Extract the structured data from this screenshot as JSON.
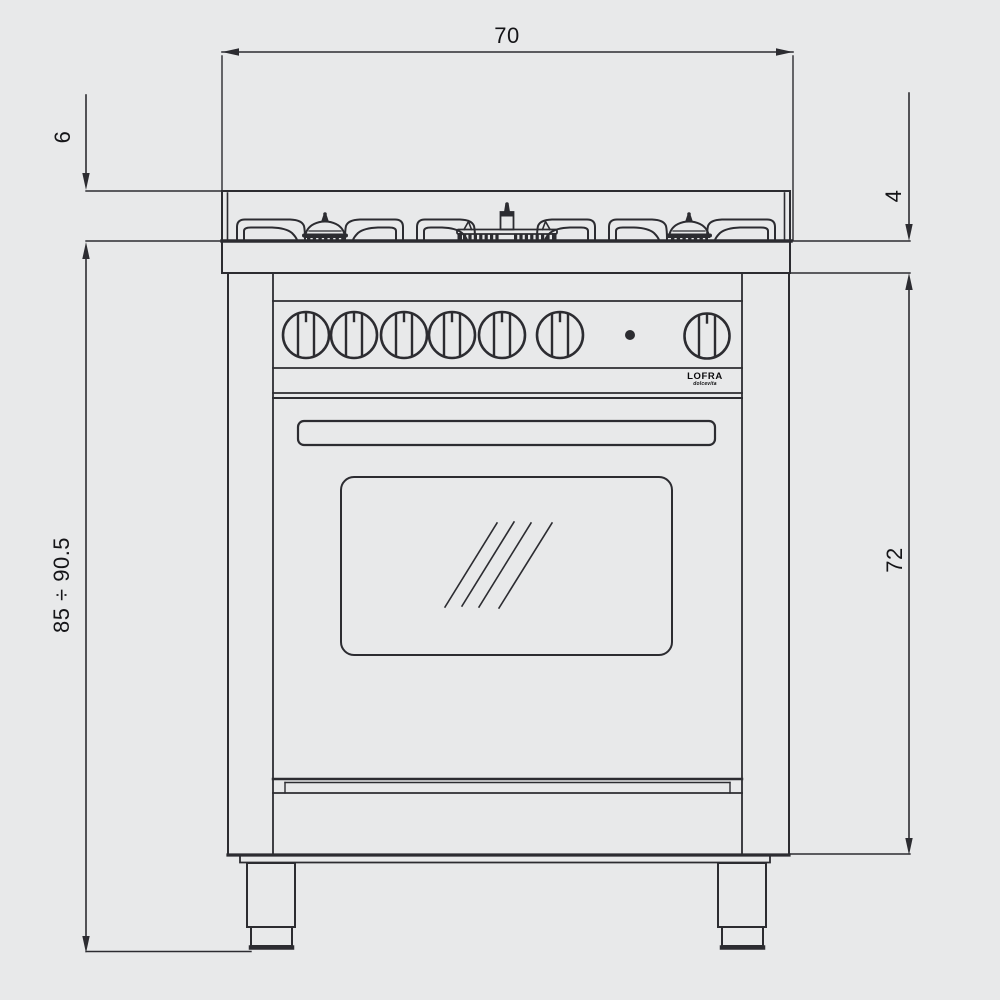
{
  "colors": {
    "background": "#e8e9ea",
    "line": "#2c2c31",
    "label_text": "#151518"
  },
  "dimension_labels": {
    "top_width": "70",
    "backguard_height": "6",
    "worktop_thickness": "4",
    "overall_height_range": "85 ÷ 90.5",
    "oven_body_height": "72"
  },
  "logo": {
    "brand": "LOFRA",
    "subtext": "dolcevita"
  },
  "controls": {
    "knob_count": 7,
    "indicator_light_count": 1
  },
  "hob": {
    "burner_count": 3
  }
}
